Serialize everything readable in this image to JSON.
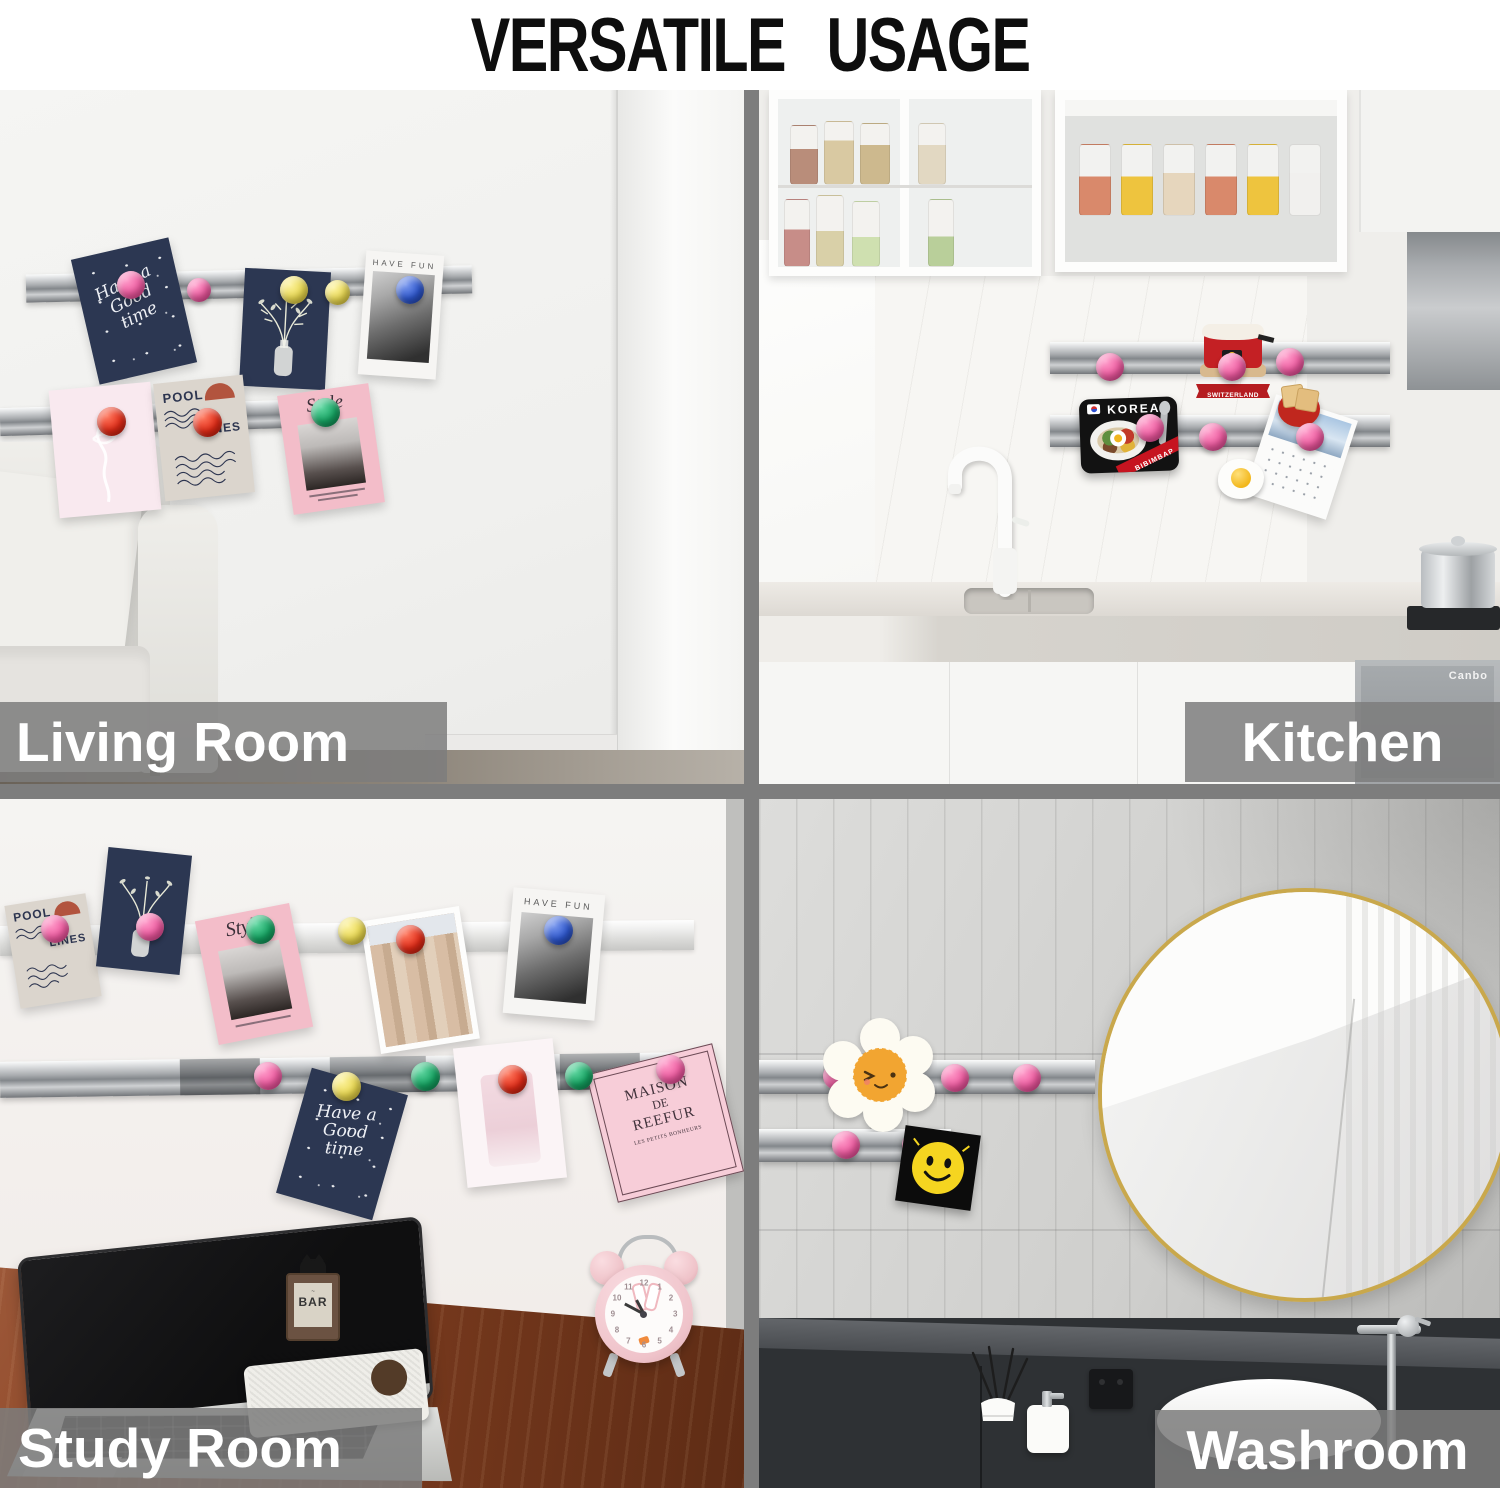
{
  "title": "VERSATILE  USAGE",
  "scenes": {
    "living_room": {
      "label": "Living Room"
    },
    "kitchen": {
      "label": "Kitchen"
    },
    "study_room": {
      "label": "Study Room"
    },
    "washroom": {
      "label": "Washroom"
    }
  },
  "cards": {
    "script_greeting": {
      "line1": "Have a",
      "line2": "Good",
      "line3": "time"
    },
    "pool_lines": {
      "word1": "POOL",
      "word2": "LINES"
    },
    "have_fun": {
      "caption": "HAVE FUN"
    },
    "style_magazine": {
      "title": "Style"
    },
    "maison": {
      "line1": "MAISON",
      "line2": "DE",
      "line3": "REEFUR",
      "subtitle": "LES PETITS BONHEURS"
    }
  },
  "magnet_cards": {
    "korea": {
      "title": "KOREA",
      "ribbon": "BIBIMBAP"
    },
    "switzerland": {
      "banner": "SWITZERLAND"
    }
  },
  "study_desk": {
    "bar_sign": "BAR",
    "laptop_brand": "MacBook Pro",
    "clock_numbers": [
      "12",
      "1",
      "2",
      "3",
      "4",
      "5",
      "6",
      "7",
      "8",
      "9",
      "10",
      "11"
    ]
  },
  "kitchen_items": {
    "appliance_brand": "Canbo"
  },
  "colors": {
    "magnet_pink": "#ee5ba0",
    "magnet_red": "#df2b17",
    "magnet_yellow": "#e7d64f",
    "magnet_blue": "#2d56cc",
    "magnet_green": "#15a261",
    "divider_gray": "#7d7d7d",
    "label_bar_gray": "#7d7d7d",
    "mirror_rim_gold": "#c9a84c",
    "navy_card": "#2c3752",
    "wood_desk": "#7d3c1f"
  }
}
